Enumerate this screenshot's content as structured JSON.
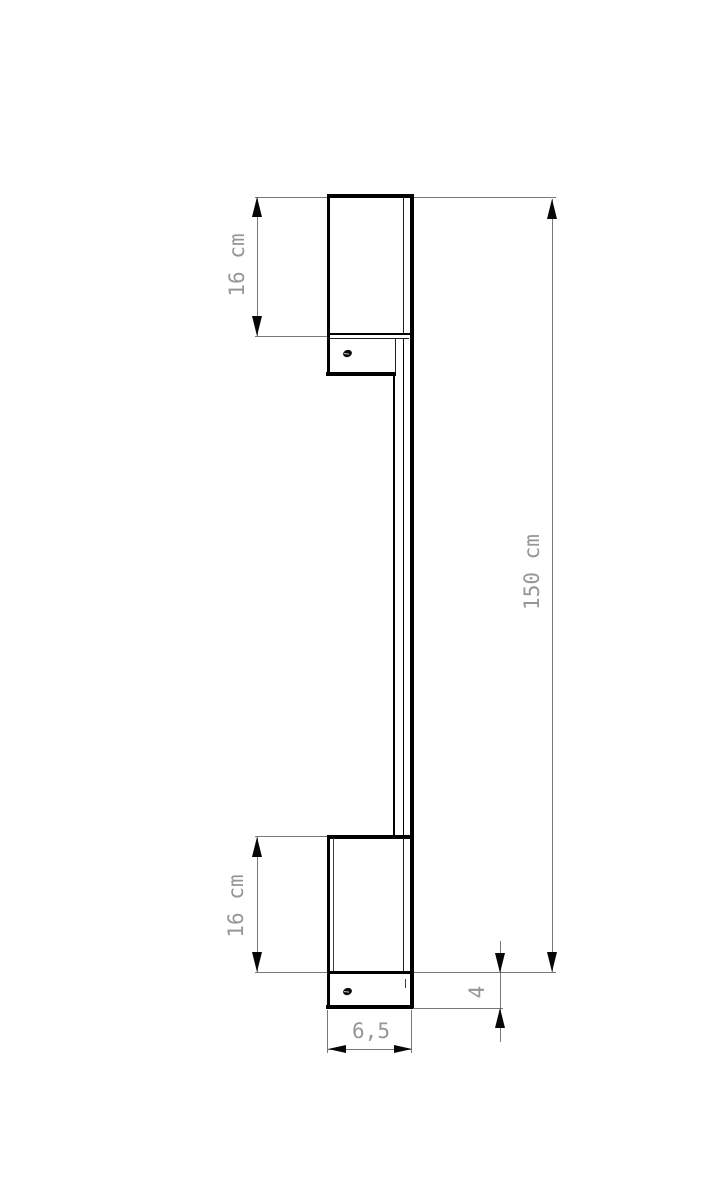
{
  "drawing": {
    "type": "technical-dimension-drawing",
    "subject": "wall-mounted linear lamp, side view",
    "background": "#ffffff"
  },
  "dimensions": {
    "top_shade_length": "16 cm",
    "bottom_shade_length": "16 cm",
    "overall_length": "150 cm",
    "bracket_height": "4",
    "body_width": "6,5"
  },
  "colors": {
    "structure_line": "#000000",
    "dimension_line": "#787878",
    "label_text": "#969696"
  }
}
